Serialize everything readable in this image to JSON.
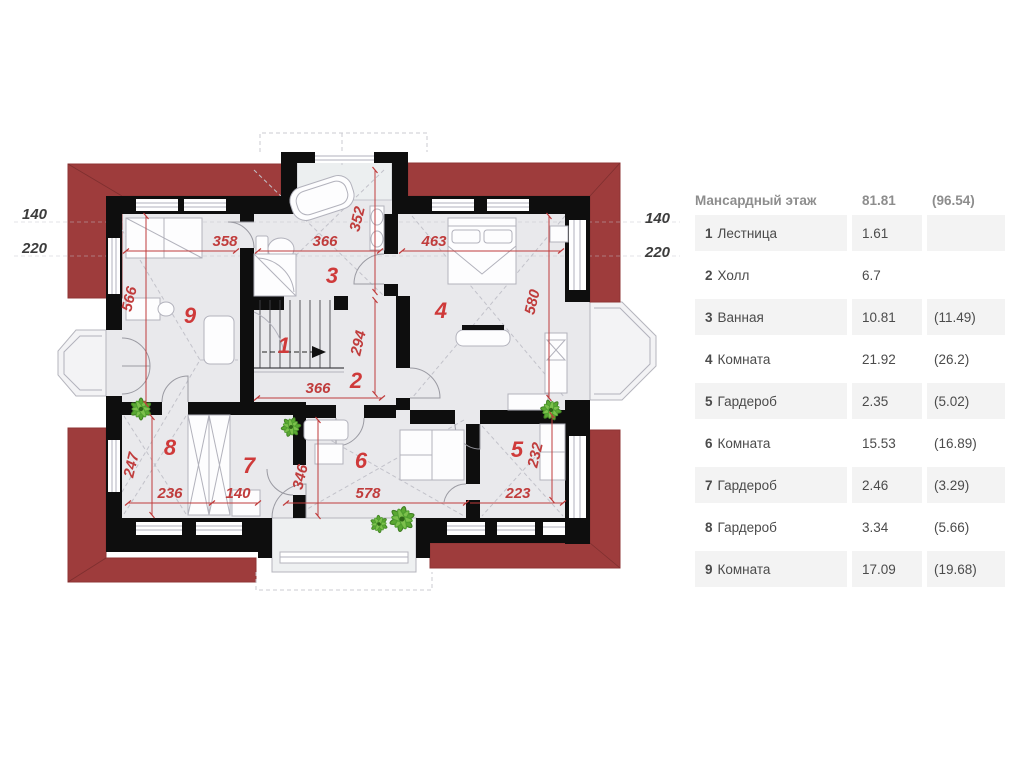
{
  "table": {
    "title": "Мансардный этаж",
    "total_area": "81.81",
    "total_area_full": "(96.54)",
    "rows": [
      {
        "num": "1",
        "name": "Лестница",
        "area": "1.61",
        "full": ""
      },
      {
        "num": "2",
        "name": "Холл",
        "area": "6.7",
        "full": ""
      },
      {
        "num": "3",
        "name": "Ванная",
        "area": "10.81",
        "full": "(11.49)"
      },
      {
        "num": "4",
        "name": "Комната",
        "area": "21.92",
        "full": "(26.2)"
      },
      {
        "num": "5",
        "name": "Гардероб",
        "area": "2.35",
        "full": "(5.02)"
      },
      {
        "num": "6",
        "name": "Комната",
        "area": "15.53",
        "full": "(16.89)"
      },
      {
        "num": "7",
        "name": "Гардероб",
        "area": "2.46",
        "full": "(3.29)"
      },
      {
        "num": "8",
        "name": "Гардероб",
        "area": "3.34",
        "full": "(5.66)"
      },
      {
        "num": "9",
        "name": "Комната",
        "area": "17.09",
        "full": "(19.68)"
      }
    ]
  },
  "plan": {
    "room_numbers": [
      "1",
      "2",
      "3",
      "4",
      "5",
      "6",
      "7",
      "8",
      "9"
    ],
    "dimensions": [
      "358",
      "366",
      "352",
      "463",
      "566",
      "580",
      "294",
      "366",
      "247",
      "236",
      "140",
      "346",
      "578",
      "223",
      "232"
    ],
    "side_dimensions": [
      "140",
      "220",
      "140",
      "220"
    ],
    "colors": {
      "roof": "#9e3c3c",
      "wall": "#0e0e0e",
      "dimension_red": "#c03c3c",
      "floor": "#e9e9ec",
      "plant_green": "#54a12f"
    }
  }
}
